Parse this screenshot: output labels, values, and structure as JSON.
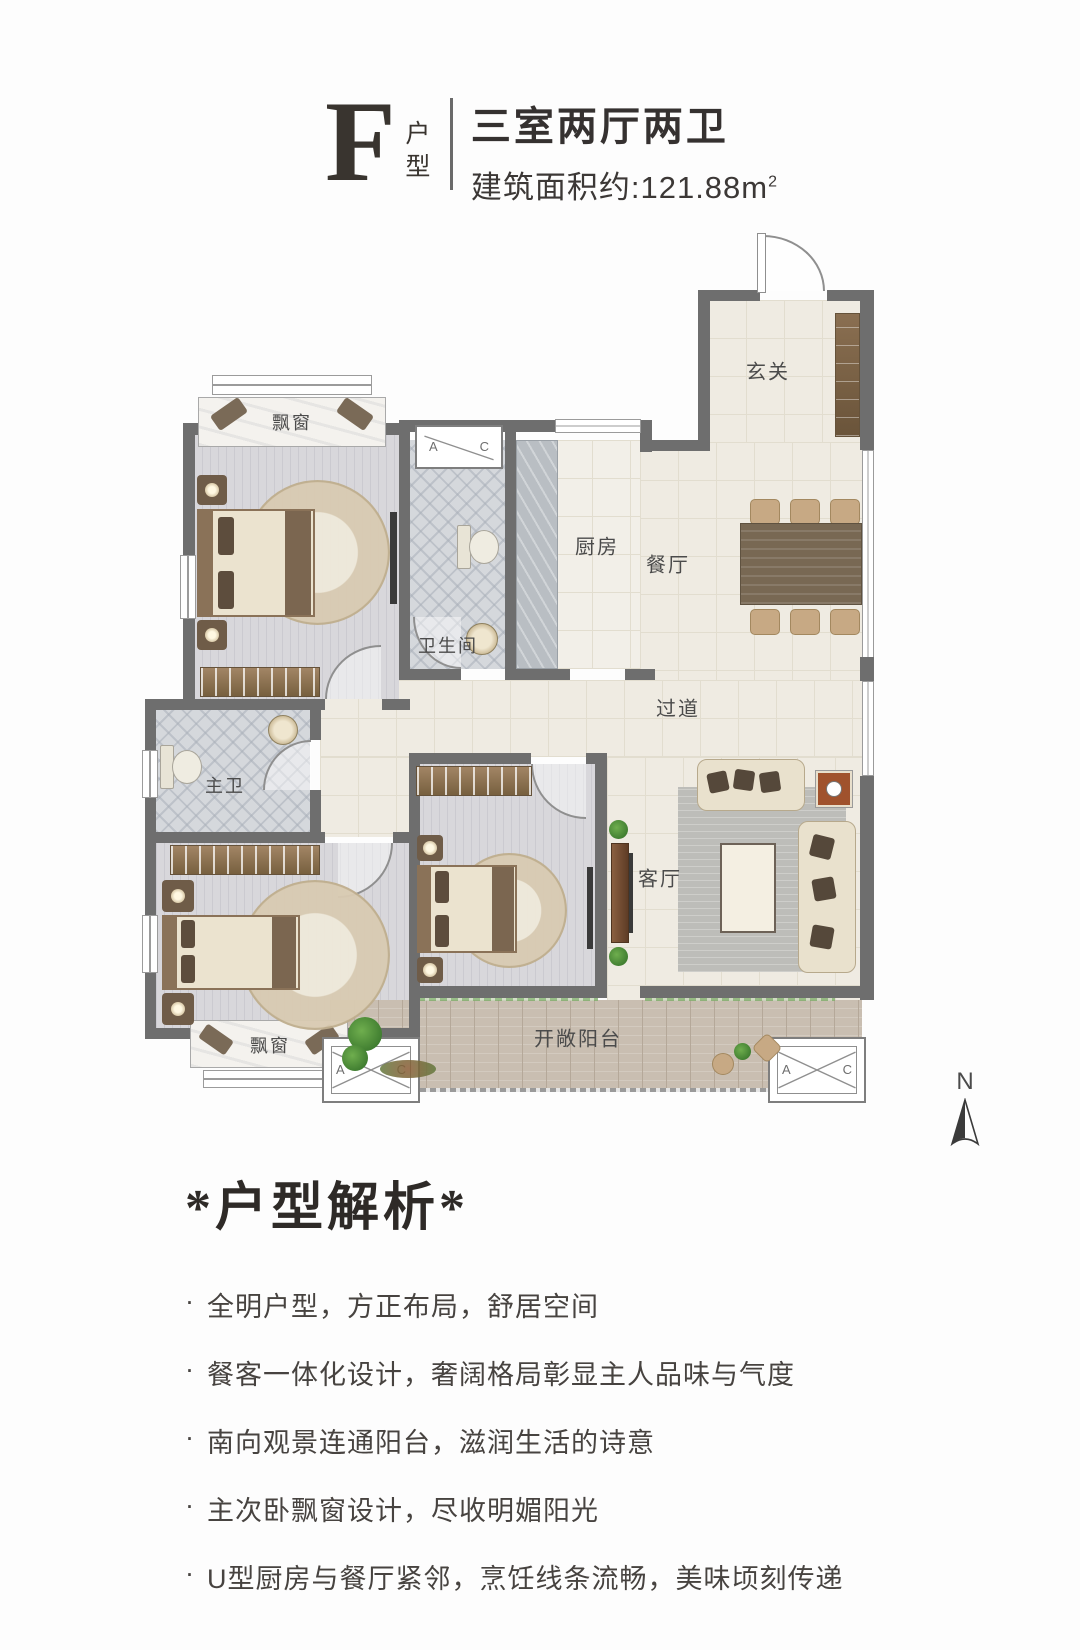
{
  "header": {
    "unit_letter": "F",
    "unit_suffix": "户型",
    "rooms_title": "三室两厅两卫",
    "area_line": "建筑面积约:121.88m",
    "area_sup": "2"
  },
  "plan": {
    "rooms": {
      "entry": "玄关",
      "kitchen": "厨房",
      "dining": "餐厅",
      "bath": "卫生间",
      "hallway": "过道",
      "master_bath": "主卫",
      "living": "客厅",
      "bay_top": "飘窗",
      "bay_bottom": "飘窗",
      "balcony": "开敞阳台"
    },
    "ac": {
      "a": "A",
      "c": "C"
    },
    "compass_n": "N"
  },
  "analysis": {
    "title": "*户型解析*",
    "bullet_marker": "·",
    "bullets": [
      "全明户型，方正布局，舒居空间",
      "餐客一体化设计，奢阔格局彰显主人品味与气度",
      "南向观景连通阳台，滋润生活的诗意",
      "主次卧飘窗设计，尽收明媚阳光",
      "U型厨房与餐厅紧邻，烹饪线条流畅，美味顷刻传递"
    ]
  },
  "colors": {
    "wall": "#6e6e6e",
    "floor_cream": "#efebe2",
    "floor_bedroom": "#d8d7db",
    "wood_accent": "#8a7258",
    "text": "#3c3836"
  }
}
